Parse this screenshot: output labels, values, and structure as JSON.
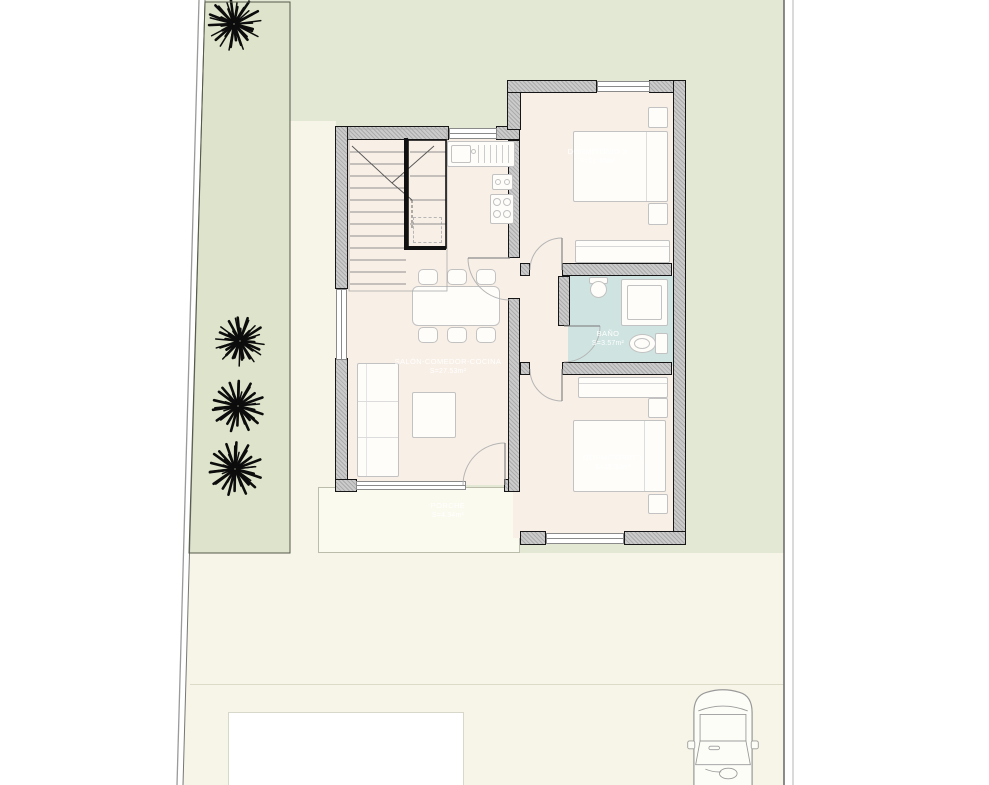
{
  "rooms": [
    {
      "id": "dormitorio-2",
      "name": "DORMITORIO 2",
      "area": "S=12.16m²"
    },
    {
      "id": "bano",
      "name": "BAÑO",
      "area": "S=3.57m²"
    },
    {
      "id": "salon",
      "name": "SALÓN-COMEDOR-COCINA",
      "area": "S=27.53m²"
    },
    {
      "id": "dormitorio-1",
      "name": "DORMITORIO 1",
      "area": "S=11.32m²"
    },
    {
      "id": "porche",
      "name": "PORCHE",
      "area": "S=4.34m²"
    }
  ],
  "site": {
    "trees": [
      {
        "cx": 234,
        "cy": 24,
        "r": 27
      },
      {
        "cx": 240,
        "cy": 341,
        "r": 25
      },
      {
        "cx": 238,
        "cy": 406,
        "r": 26
      },
      {
        "cx": 235,
        "cy": 469,
        "r": 27
      }
    ],
    "colors": {
      "garden": "#e3e8d4",
      "garden_strip": "#dde4cb",
      "paving": "#f7f5e7",
      "house_floor": "#f8efe6",
      "bathroom_floor": "#cfe4e1",
      "wall_fill": "#cbcbcb",
      "wall_line": "#161616",
      "pool": "#ffffff",
      "tree": "#0c0c0c"
    }
  }
}
